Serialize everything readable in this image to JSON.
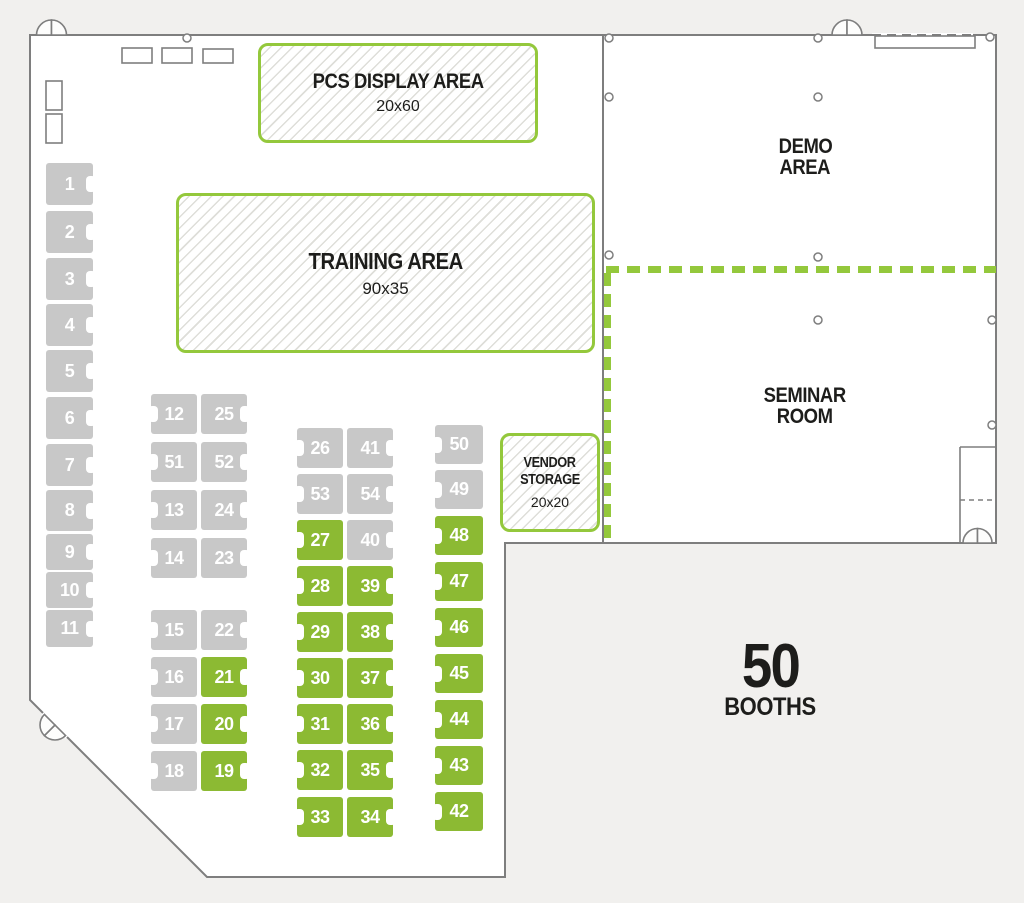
{
  "palette": {
    "booth_green": "#8CBA33",
    "booth_gray": "#C8C8C8",
    "area_border_green": "#94C83C",
    "wall_gray": "#7E7E7E",
    "text_ink": "#1d1d1b"
  },
  "areas": {
    "pcs_display": {
      "title": "PCS DISPLAY AREA",
      "size": "20x60"
    },
    "training": {
      "title": "TRAINING AREA",
      "size": "90x35"
    },
    "demo": {
      "line1": "DEMO",
      "line2": "AREA"
    },
    "seminar": {
      "line1": "SEMINAR",
      "line2": "ROOM"
    },
    "vendor_storage": {
      "line1": "VENDOR",
      "line2": "STORAGE",
      "size": "20x20"
    },
    "booth_total": {
      "number": "50",
      "label": "BOOTHS"
    }
  },
  "booths": [
    {
      "id": "1",
      "x": 46,
      "y": 163,
      "w": 47,
      "h": 42,
      "color": "gray",
      "notch": "right"
    },
    {
      "id": "2",
      "x": 46,
      "y": 211,
      "w": 47,
      "h": 42,
      "color": "gray",
      "notch": "right"
    },
    {
      "id": "3",
      "x": 46,
      "y": 258,
      "w": 47,
      "h": 42,
      "color": "gray",
      "notch": "right"
    },
    {
      "id": "4",
      "x": 46,
      "y": 304,
      "w": 47,
      "h": 42,
      "color": "gray",
      "notch": "right"
    },
    {
      "id": "5",
      "x": 46,
      "y": 350,
      "w": 47,
      "h": 42,
      "color": "gray",
      "notch": "right"
    },
    {
      "id": "6",
      "x": 46,
      "y": 397,
      "w": 47,
      "h": 42,
      "color": "gray",
      "notch": "right"
    },
    {
      "id": "7",
      "x": 46,
      "y": 444,
      "w": 47,
      "h": 42,
      "color": "gray",
      "notch": "right"
    },
    {
      "id": "8",
      "x": 46,
      "y": 490,
      "w": 47,
      "h": 41,
      "color": "gray",
      "notch": "right"
    },
    {
      "id": "9",
      "x": 46,
      "y": 534,
      "w": 47,
      "h": 36,
      "color": "gray",
      "notch": "right"
    },
    {
      "id": "10",
      "x": 46,
      "y": 572,
      "w": 47,
      "h": 36,
      "color": "gray",
      "notch": "right"
    },
    {
      "id": "11",
      "x": 46,
      "y": 610,
      "w": 47,
      "h": 37,
      "color": "gray",
      "notch": "right"
    },
    {
      "id": "12",
      "x": 151,
      "y": 394,
      "w": 46,
      "h": 40,
      "color": "gray",
      "notch": "left"
    },
    {
      "id": "25",
      "x": 201,
      "y": 394,
      "w": 46,
      "h": 40,
      "color": "gray",
      "notch": "right"
    },
    {
      "id": "51",
      "x": 151,
      "y": 442,
      "w": 46,
      "h": 40,
      "color": "gray",
      "notch": "left"
    },
    {
      "id": "52",
      "x": 201,
      "y": 442,
      "w": 46,
      "h": 40,
      "color": "gray",
      "notch": "right"
    },
    {
      "id": "13",
      "x": 151,
      "y": 490,
      "w": 46,
      "h": 40,
      "color": "gray",
      "notch": "left"
    },
    {
      "id": "24",
      "x": 201,
      "y": 490,
      "w": 46,
      "h": 40,
      "color": "gray",
      "notch": "right"
    },
    {
      "id": "14",
      "x": 151,
      "y": 538,
      "w": 46,
      "h": 40,
      "color": "gray",
      "notch": "left"
    },
    {
      "id": "23",
      "x": 201,
      "y": 538,
      "w": 46,
      "h": 40,
      "color": "gray",
      "notch": "right"
    },
    {
      "id": "15",
      "x": 151,
      "y": 610,
      "w": 46,
      "h": 40,
      "color": "gray",
      "notch": "left"
    },
    {
      "id": "22",
      "x": 201,
      "y": 610,
      "w": 46,
      "h": 40,
      "color": "gray",
      "notch": "right"
    },
    {
      "id": "16",
      "x": 151,
      "y": 657,
      "w": 46,
      "h": 40,
      "color": "gray",
      "notch": "left"
    },
    {
      "id": "21",
      "x": 201,
      "y": 657,
      "w": 46,
      "h": 40,
      "color": "green",
      "notch": "right"
    },
    {
      "id": "17",
      "x": 151,
      "y": 704,
      "w": 46,
      "h": 40,
      "color": "gray",
      "notch": "left"
    },
    {
      "id": "20",
      "x": 201,
      "y": 704,
      "w": 46,
      "h": 40,
      "color": "green",
      "notch": "right"
    },
    {
      "id": "18",
      "x": 151,
      "y": 751,
      "w": 46,
      "h": 40,
      "color": "gray",
      "notch": "left"
    },
    {
      "id": "19",
      "x": 201,
      "y": 751,
      "w": 46,
      "h": 40,
      "color": "green",
      "notch": "right"
    },
    {
      "id": "26",
      "x": 297,
      "y": 428,
      "w": 46,
      "h": 40,
      "color": "gray",
      "notch": "left"
    },
    {
      "id": "41",
      "x": 347,
      "y": 428,
      "w": 46,
      "h": 40,
      "color": "gray",
      "notch": "right"
    },
    {
      "id": "53",
      "x": 297,
      "y": 474,
      "w": 46,
      "h": 40,
      "color": "gray",
      "notch": "left"
    },
    {
      "id": "54",
      "x": 347,
      "y": 474,
      "w": 46,
      "h": 40,
      "color": "gray",
      "notch": "right"
    },
    {
      "id": "27",
      "x": 297,
      "y": 520,
      "w": 46,
      "h": 40,
      "color": "green",
      "notch": "left"
    },
    {
      "id": "40",
      "x": 347,
      "y": 520,
      "w": 46,
      "h": 40,
      "color": "gray",
      "notch": "right"
    },
    {
      "id": "28",
      "x": 297,
      "y": 566,
      "w": 46,
      "h": 40,
      "color": "green",
      "notch": "left"
    },
    {
      "id": "39",
      "x": 347,
      "y": 566,
      "w": 46,
      "h": 40,
      "color": "green",
      "notch": "right"
    },
    {
      "id": "29",
      "x": 297,
      "y": 612,
      "w": 46,
      "h": 40,
      "color": "green",
      "notch": "left"
    },
    {
      "id": "38",
      "x": 347,
      "y": 612,
      "w": 46,
      "h": 40,
      "color": "green",
      "notch": "right"
    },
    {
      "id": "30",
      "x": 297,
      "y": 658,
      "w": 46,
      "h": 40,
      "color": "green",
      "notch": "left"
    },
    {
      "id": "37",
      "x": 347,
      "y": 658,
      "w": 46,
      "h": 40,
      "color": "green",
      "notch": "right"
    },
    {
      "id": "31",
      "x": 297,
      "y": 704,
      "w": 46,
      "h": 40,
      "color": "green",
      "notch": "left"
    },
    {
      "id": "36",
      "x": 347,
      "y": 704,
      "w": 46,
      "h": 40,
      "color": "green",
      "notch": "right"
    },
    {
      "id": "32",
      "x": 297,
      "y": 750,
      "w": 46,
      "h": 40,
      "color": "green",
      "notch": "left"
    },
    {
      "id": "35",
      "x": 347,
      "y": 750,
      "w": 46,
      "h": 40,
      "color": "green",
      "notch": "right"
    },
    {
      "id": "33",
      "x": 297,
      "y": 797,
      "w": 46,
      "h": 40,
      "color": "green",
      "notch": "left"
    },
    {
      "id": "34",
      "x": 347,
      "y": 797,
      "w": 46,
      "h": 40,
      "color": "green",
      "notch": "right"
    },
    {
      "id": "50",
      "x": 435,
      "y": 425,
      "w": 48,
      "h": 39,
      "color": "gray",
      "notch": "left"
    },
    {
      "id": "49",
      "x": 435,
      "y": 470,
      "w": 48,
      "h": 39,
      "color": "gray",
      "notch": "left"
    },
    {
      "id": "48",
      "x": 435,
      "y": 516,
      "w": 48,
      "h": 39,
      "color": "green",
      "notch": "left"
    },
    {
      "id": "47",
      "x": 435,
      "y": 562,
      "w": 48,
      "h": 39,
      "color": "green",
      "notch": "left"
    },
    {
      "id": "46",
      "x": 435,
      "y": 608,
      "w": 48,
      "h": 39,
      "color": "green",
      "notch": "left"
    },
    {
      "id": "45",
      "x": 435,
      "y": 654,
      "w": 48,
      "h": 39,
      "color": "green",
      "notch": "left"
    },
    {
      "id": "44",
      "x": 435,
      "y": 700,
      "w": 48,
      "h": 39,
      "color": "green",
      "notch": "left"
    },
    {
      "id": "43",
      "x": 435,
      "y": 746,
      "w": 48,
      "h": 39,
      "color": "green",
      "notch": "left"
    },
    {
      "id": "42",
      "x": 435,
      "y": 792,
      "w": 48,
      "h": 39,
      "color": "green",
      "notch": "left"
    }
  ]
}
